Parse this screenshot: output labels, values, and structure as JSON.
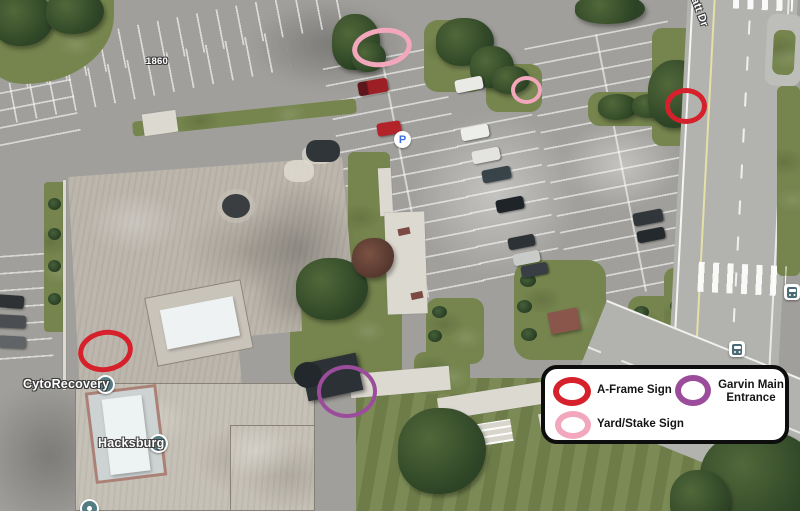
{
  "map": {
    "street_label": "att Dr",
    "building_number": "1860",
    "parking_glyph": "P",
    "poi": [
      {
        "name": "CytoRecovery"
      },
      {
        "name": "Hacksburg"
      }
    ]
  },
  "legend": {
    "items": [
      {
        "id": "a-frame",
        "label": "A-Frame Sign",
        "color": "#d6202b"
      },
      {
        "id": "garvin",
        "label": "Garvin Main Entrance",
        "color": "#9b4d9b"
      },
      {
        "id": "yard",
        "label": "Yard/Stake Sign",
        "color": "#f2a7bd"
      }
    ]
  },
  "annotations": [
    {
      "name": "a-frame-sign-circle-left",
      "color": "#d6202b",
      "x": 78,
      "y": 330,
      "w": 55,
      "h": 42,
      "stroke": 5.5,
      "rot": -10
    },
    {
      "name": "a-frame-sign-circle-road",
      "color": "#d6202b",
      "x": 665,
      "y": 88,
      "w": 42,
      "h": 36,
      "stroke": 5,
      "rot": 0
    },
    {
      "name": "yard-stake-sign-circle-top",
      "color": "#f2a7bd",
      "x": 352,
      "y": 28,
      "w": 60,
      "h": 39,
      "stroke": 5,
      "rot": -8
    },
    {
      "name": "yard-stake-sign-circle-mid",
      "color": "#f2a7bd",
      "x": 511,
      "y": 76,
      "w": 31,
      "h": 28,
      "stroke": 4.5,
      "rot": 0
    },
    {
      "name": "garvin-main-entrance-circle",
      "color": "#9b4d9b",
      "x": 317,
      "y": 365,
      "w": 60,
      "h": 53,
      "stroke": 4.5,
      "rot": 0
    }
  ]
}
